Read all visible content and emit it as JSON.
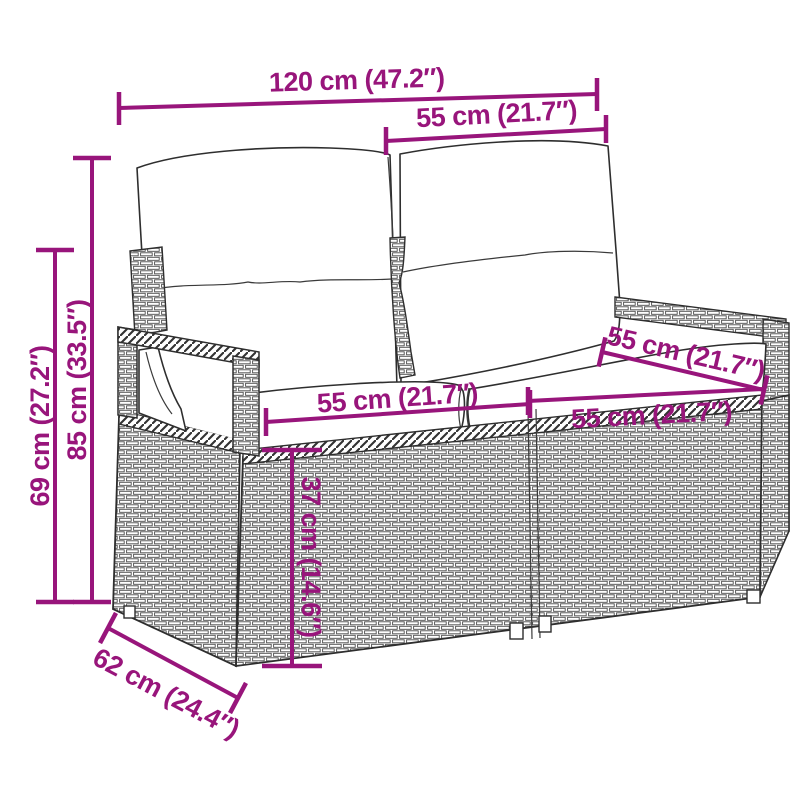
{
  "diagram": {
    "kind": "product-dimension-diagram",
    "subject": "rattan-2-seater-garden-sofa-with-cushions",
    "accent_color": "#98157B",
    "drawing_line_color": "#2e2e2e",
    "background_color": "#ffffff"
  },
  "dimensions": {
    "total_width": {
      "label": "120 cm (47.2″)"
    },
    "back_width": {
      "label": "55 cm (21.7″)"
    },
    "total_height": {
      "label": "85 cm (33.5″)"
    },
    "arm_height": {
      "label": "69 cm (27.2″)"
    },
    "seat_width_left": {
      "label": "55 cm (21.7″)"
    },
    "seat_width_right": {
      "label": "55 cm (21.7″)"
    },
    "seat_depth": {
      "label": "55 cm (21.7″)"
    },
    "seat_height": {
      "label": "37 cm (14.6″)"
    },
    "total_depth": {
      "label": "62 cm (24.4″)"
    }
  }
}
